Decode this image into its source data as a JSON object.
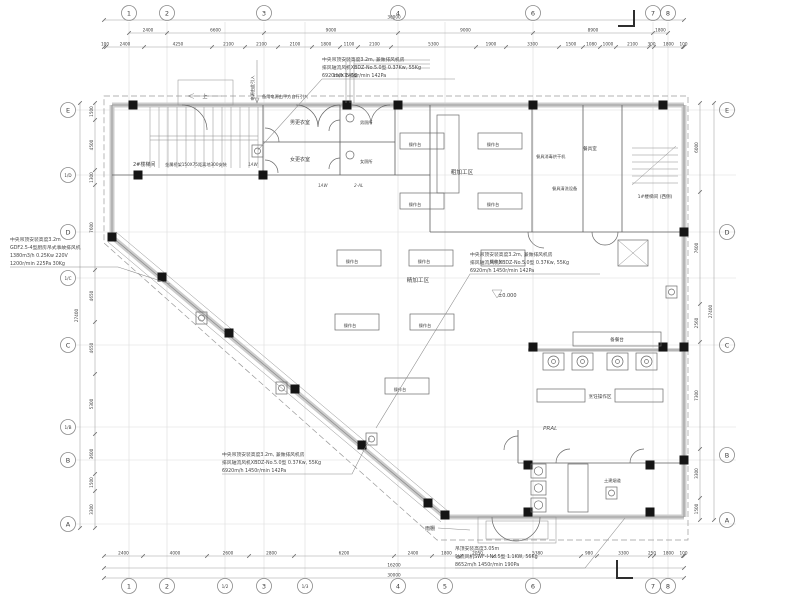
{
  "grid": {
    "top": [
      "1",
      "2",
      "3",
      "4",
      "6",
      "7",
      "8"
    ],
    "bottom": [
      "1",
      "2",
      "1/2",
      "3",
      "1/3",
      "4",
      "5",
      "6",
      "7",
      "8"
    ],
    "left": [
      "E",
      "1/D",
      "D",
      "1/C",
      "C",
      "1/B",
      "B",
      "A"
    ],
    "right": [
      "E",
      "D",
      "C",
      "B",
      "A"
    ]
  },
  "dims": {
    "top_overall": "30000",
    "top_row1": [
      "2400",
      "6600",
      "9000",
      "9000",
      "8900",
      "1800"
    ],
    "top_row2": [
      "100",
      "2400",
      "4250",
      "2100",
      "2100",
      "2100",
      "1800",
      "1100",
      "2100",
      "5300",
      "1900",
      "3300",
      "1500",
      "1080",
      "1000",
      "2100",
      "300",
      "1800",
      "100"
    ],
    "bottom_row": [
      "2400",
      "4000",
      "2600",
      "2800",
      "6200",
      "2400",
      "1800",
      "2050",
      "5380",
      "980",
      "3300",
      "250",
      "1800",
      "100"
    ],
    "bottom_overall_1": "16200",
    "bottom_overall_2": "30000",
    "left_chain": [
      "1500",
      "4500",
      "1300",
      "7600",
      "4650",
      "4650",
      "5300",
      "3600",
      "1500",
      "3300"
    ],
    "left_overall": "27400",
    "right_chain": [
      "6000",
      "7600",
      "2560",
      "7300",
      "3300",
      "1500"
    ],
    "right_overall": "27400"
  },
  "rooms": {
    "stair2": "2#楼梯间",
    "stair1": "1#楼梯间 (西侧)",
    "male_changing": "男更衣室",
    "female_changing": "女更衣室",
    "male_toilet": "男厕所",
    "female_toilet": "女厕所",
    "rough_area": "粗加工区",
    "fine_area": "精加工区",
    "cooking_area": "烹饪操作区",
    "dish_room": "餐具室",
    "dish_wash": "餐具清洗设备",
    "dish_dry": "餐具消毒烘干机",
    "prep_table": "备餐台",
    "op_table": "操作台",
    "smoke_duct": "土建烟道",
    "canopy": "雨棚"
  },
  "annotations": {
    "fan_xbdz_1": "中央吊顶安装高度3.2m, 兼做排风机房",
    "fan_xbdz_2": "排风轴流风机XBDZ-No.5.0型  0.37Kw, 55Kg",
    "fan_xbdz_3": "6920m/h  1450r/min  142Pa",
    "fan_gdf_1": "中央吊顶安装高度3.2m",
    "fan_gdf_2": "GDF2.5-4型厨房吊式事故排风机",
    "fan_gdf_3": "1380m3/h  0.25Kw  220V",
    "fan_gdf_4": "1200r/min  225Pa  30Kg",
    "fan_swf_1": "吊顶安装高度3.05m",
    "fan_swf_2": "轴流风机SWF-I-No.5型  1.1KW, 56Kg",
    "fan_swf_3": "8652m/h  1450r/min  190Pa",
    "power_in": "电源由此引入",
    "backup_power": "备用电源由甲方自行引入",
    "tray": "150X75桥架",
    "tray_note": "金属桥架150X75距离地300安装",
    "level": "±0.000",
    "up": "上"
  },
  "codes": {
    "aw": "1AW",
    "al": "2-AL",
    "pral": "PRAL"
  }
}
